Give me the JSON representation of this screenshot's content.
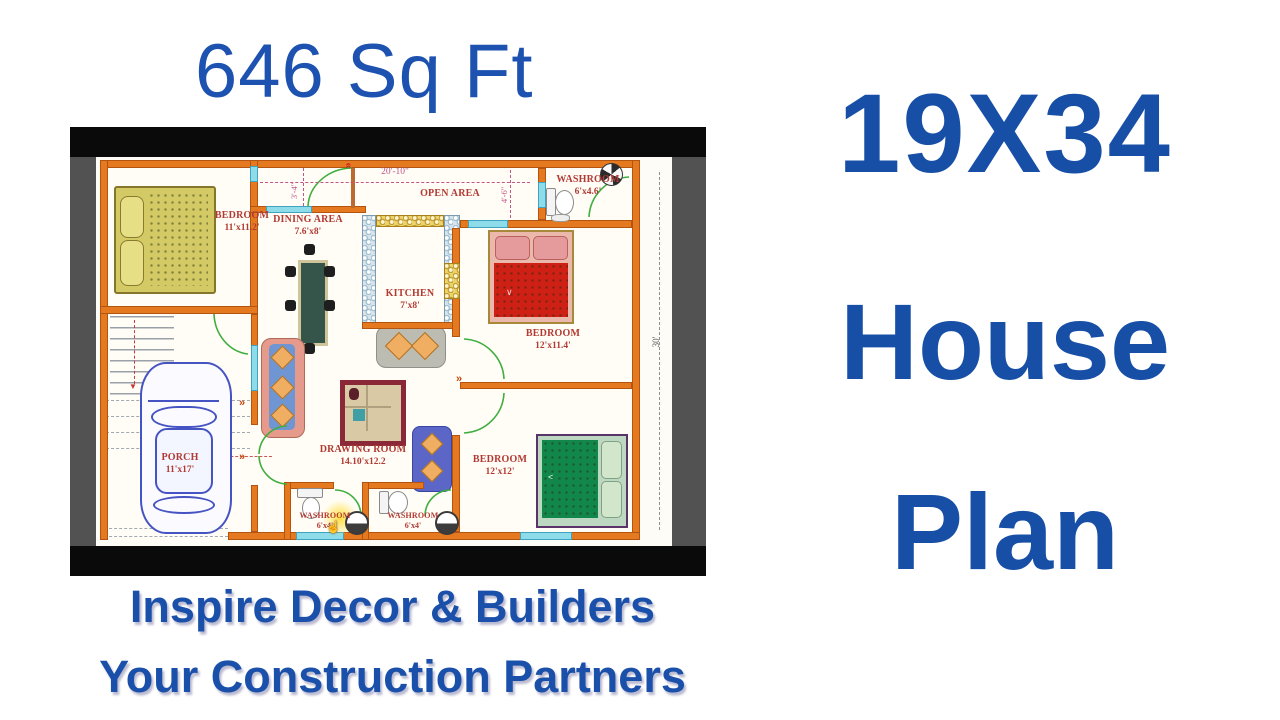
{
  "title": {
    "area": "646 Sq Ft"
  },
  "side_title": {
    "line1": "19X34",
    "line2": "House",
    "line3": "Plan"
  },
  "footer": {
    "line1": "Inspire Decor & Builders",
    "line2": "Your Construction Partners"
  },
  "plan": {
    "dims": {
      "width_top": "20'-10\"",
      "inner_left": "3'-4\"",
      "inner_right": "4'-6\"",
      "height_side": "30'"
    },
    "rooms": {
      "open_area": {
        "name": "OPEN AREA",
        "size": ""
      },
      "bedroom_tl": {
        "name": "BEDROOM",
        "size": "11'x11.2'"
      },
      "dining": {
        "name": "DINING AREA",
        "size": "7.6'x8'"
      },
      "kitchen": {
        "name": "KITCHEN",
        "size": "7'x8'"
      },
      "washroom_tr": {
        "name": "WASHROOM",
        "size": "6'x4.6'"
      },
      "bedroom_r": {
        "name": "BEDROOM",
        "size": "12'x11.4'"
      },
      "drawing": {
        "name": "DRAWING ROOM",
        "size": "14.10'x12.2"
      },
      "bedroom_br": {
        "name": "BEDROOM",
        "size": "12'x12'"
      },
      "porch": {
        "name": "PORCH",
        "size": "11'x17'"
      },
      "washroom_b1": {
        "name": "WASHROOM",
        "size": "6'x4'"
      },
      "washroom_b2": {
        "name": "WASHROOM",
        "size": "6'x4'"
      }
    },
    "colors": {
      "wall": "#e5791f",
      "label": "#b23a33",
      "dimension": "#c25588",
      "window": "#8edce9",
      "door": "#3fae3f",
      "blue_text": "#174fa7"
    }
  }
}
